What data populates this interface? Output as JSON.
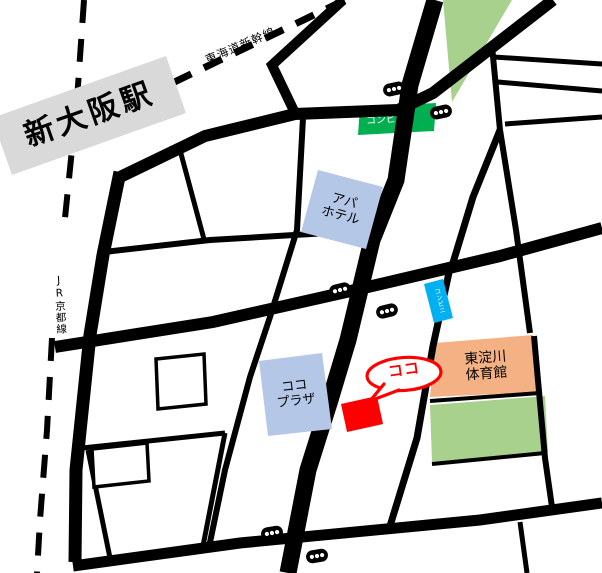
{
  "station": {
    "label": "新大阪駅"
  },
  "rail_lines": {
    "shinkansen_label": "東海道新幹線",
    "jr_label": "JR京都線"
  },
  "places": {
    "apa_hotel": {
      "line1": "アパ",
      "line2": "ホテル"
    },
    "koko_plaza": {
      "line1": "ココ",
      "line2": "プラザ"
    },
    "gym": {
      "line1": "東淀川",
      "line2": "体育館"
    },
    "convenience_store_green": {
      "label": "コンビニ"
    },
    "convenience_store_cyan": {
      "label": "コンビニ"
    },
    "destination": {
      "label": "ココ"
    }
  },
  "colors": {
    "road": "#000000",
    "station_box": "#d9d9d9",
    "hotel_box": "#b4c7e7",
    "plaza_box": "#b4c7e7",
    "cyan_box": "#00b0f0",
    "green_store_box": "#00b050",
    "park": "#a9d18e",
    "gym_box": "#f4b183",
    "marker_red": "#ff0000",
    "bubble_stroke": "#ff0000",
    "building_fill": "#ffffff"
  }
}
